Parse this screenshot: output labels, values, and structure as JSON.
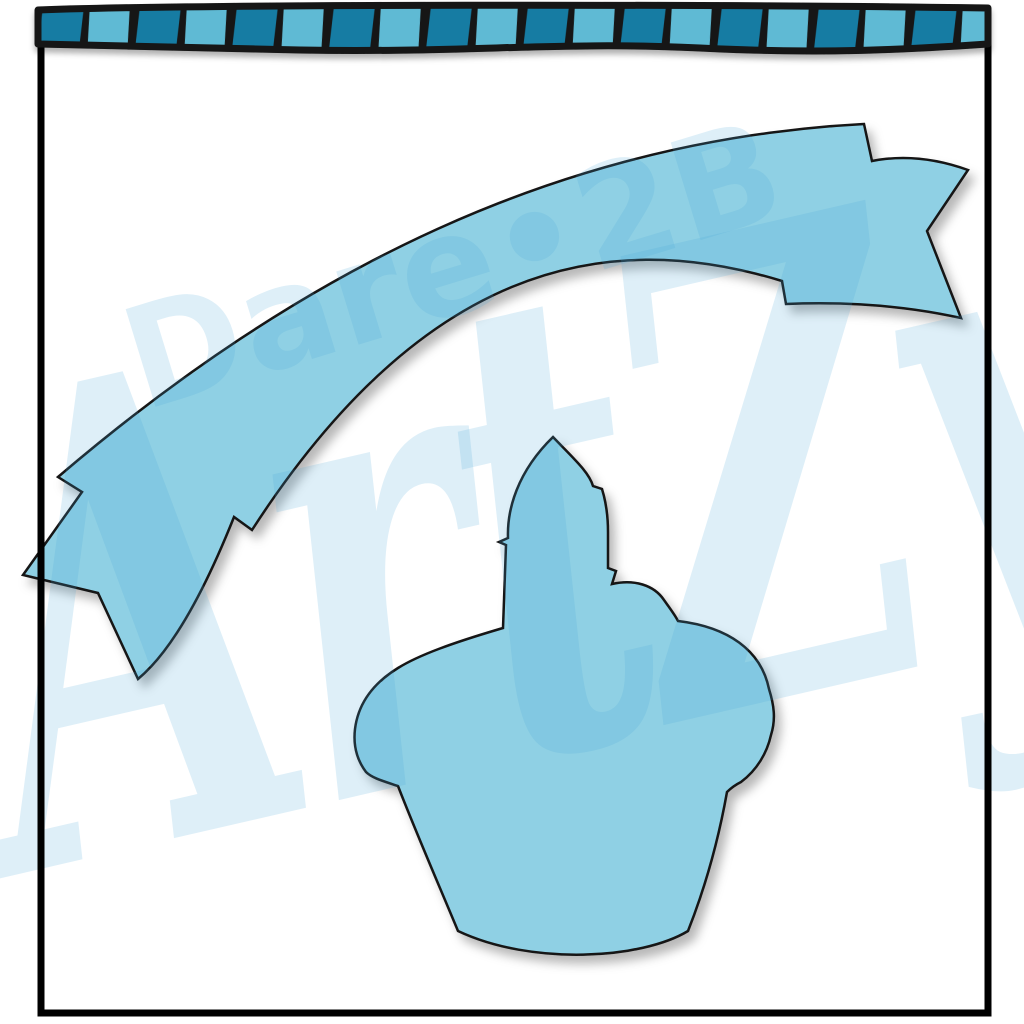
{
  "image": {
    "kind": "clipart-preview",
    "description": "Blue birthday clipart silhouettes: striped top border, curved swallowtail banner, cupcake with candle",
    "shapes": [
      "striped-top-border",
      "curved-swallowtail-banner",
      "cupcake-with-candle-silhouette"
    ]
  },
  "watermarks": {
    "primary": "Dare•2B",
    "secondary": "ArtZy"
  },
  "colors": {
    "page_bg": "#ffffff",
    "shape_fill": "#8fd0e4",
    "outline": "#141414",
    "frame": "#000000",
    "strip_dark": "#177ca3",
    "strip_light": "#5fbad4",
    "watermark": "rgba(73,168,218,0.18)",
    "shadow": "rgba(0,0,0,0.30)"
  }
}
